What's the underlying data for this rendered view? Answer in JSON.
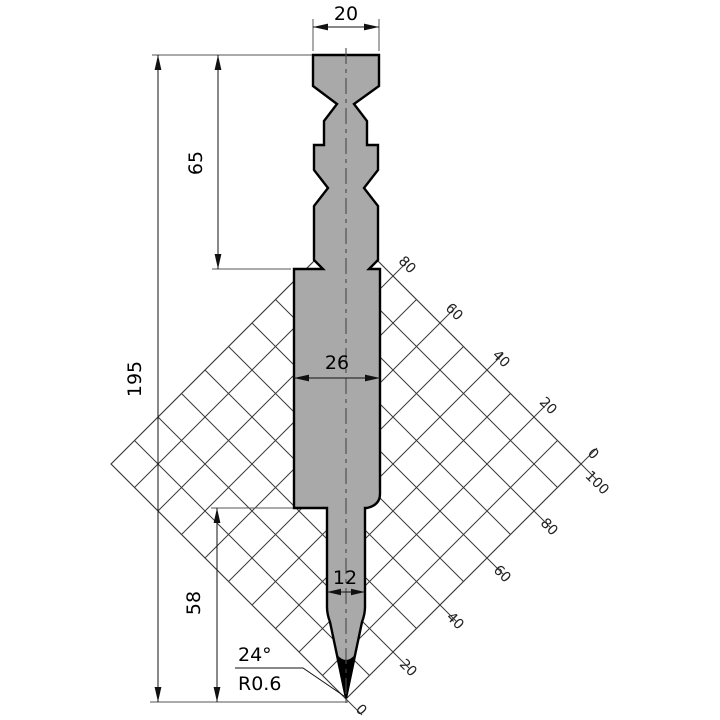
{
  "drawing": {
    "dim_top_width": "20",
    "dim_shank_height": "65",
    "dim_total_height": "195",
    "dim_body_width": "26",
    "dim_tip_section_height": "58",
    "dim_blade_width": "12",
    "dim_tip_angle": "24°",
    "dim_tip_radius": "R0.6"
  },
  "grid_scale": {
    "upper_edge_labels": [
      "80",
      "60",
      "40",
      "20",
      "0"
    ],
    "lower_edge_labels": [
      "100",
      "80",
      "60",
      "40",
      "20",
      "0"
    ]
  },
  "colors": {
    "tool_fill": "#a9a9a9",
    "tool_outline": "#000000",
    "grid_line": "#3a3a3a",
    "dimension_line": "#111111",
    "tip_fill": "#000000"
  }
}
